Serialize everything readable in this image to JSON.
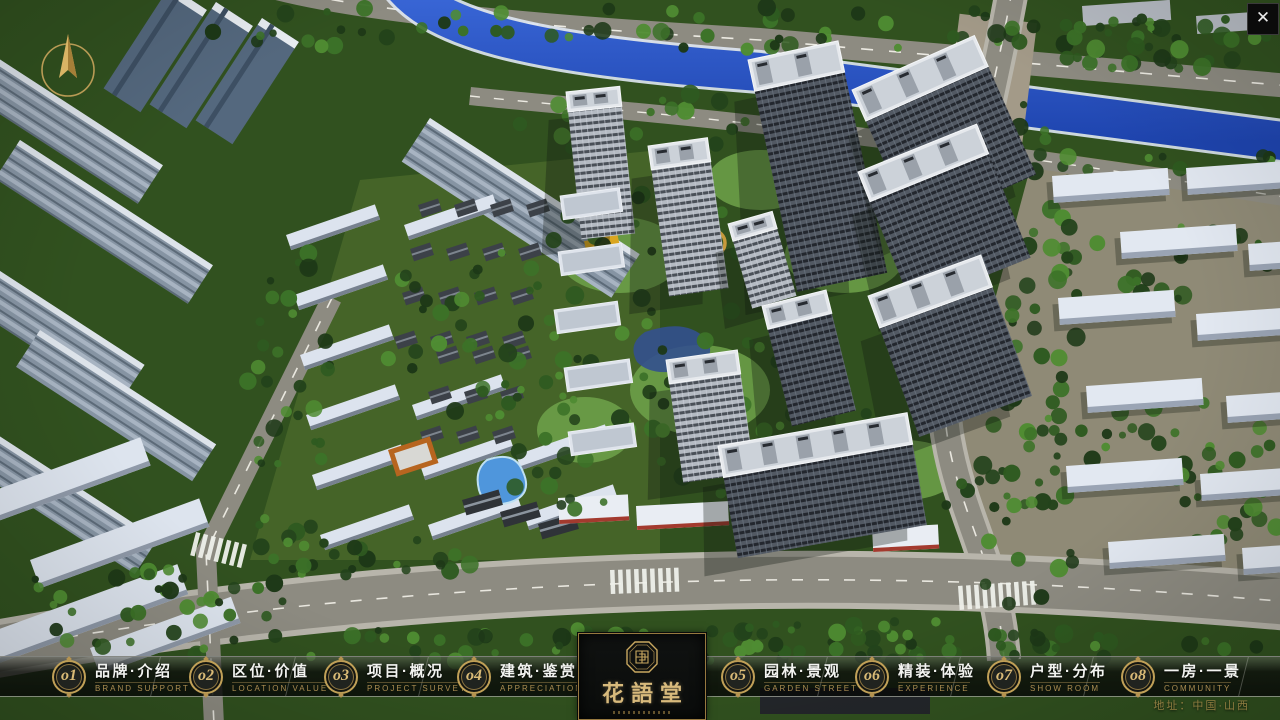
{
  "window": {
    "close_glyph": "✕"
  },
  "navbar": {
    "items": [
      {
        "num": "o1",
        "zh": "品牌·介绍",
        "en": "BRAND SUPPORT"
      },
      {
        "num": "o2",
        "zh": "区位·价值",
        "en": "LOCATION VALUE"
      },
      {
        "num": "o3",
        "zh": "项目·概况",
        "en": "PROJECT SURVEY"
      },
      {
        "num": "o4",
        "zh": "建筑·鉴赏",
        "en": "APPRECIATION"
      },
      {
        "num": "o5",
        "zh": "园林·景观",
        "en": "GARDEN STREET"
      },
      {
        "num": "o6",
        "zh": "精装·体验",
        "en": "EXPERIENCE"
      },
      {
        "num": "o7",
        "zh": "户型·分布",
        "en": "SHOW ROOM"
      },
      {
        "num": "o8",
        "zh": "一房·一景",
        "en": "COMMUNITY"
      }
    ]
  },
  "logo": {
    "title": "花語堂"
  },
  "footer": {
    "address": "地址：中国·山西"
  },
  "colors": {
    "gold": "#c0a057",
    "water": "#2853c4",
    "asphalt": "#8d8b81",
    "forest": "#2e4a22"
  }
}
